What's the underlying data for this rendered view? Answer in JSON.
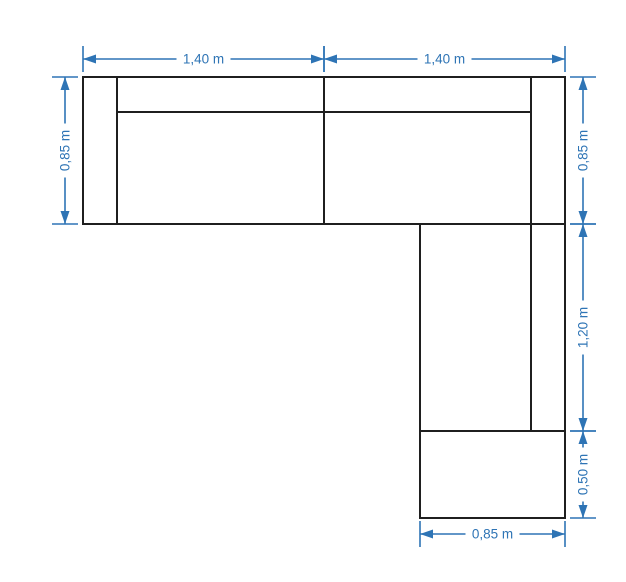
{
  "colors": {
    "accent": "#2e74b5",
    "outline": "#1f1f1f",
    "background": "#ffffff"
  },
  "drawing": {
    "figure": "l-shaped-sectional-sofa-top-view",
    "unit": "m"
  },
  "dimensions": [
    {
      "id": "top-left",
      "label": "1,40 m",
      "value_m": 1.4,
      "axis": "h",
      "at": 59,
      "from": 83,
      "to": 324
    },
    {
      "id": "top-right",
      "label": "1,40 m",
      "value_m": 1.4,
      "axis": "h",
      "at": 59,
      "from": 324,
      "to": 565
    },
    {
      "id": "left",
      "label": "0,85 m",
      "value_m": 0.85,
      "axis": "v",
      "at": 65,
      "from": 77,
      "to": 224
    },
    {
      "id": "right-upper",
      "label": "0,85 m",
      "value_m": 0.85,
      "axis": "v",
      "at": 583,
      "from": 77,
      "to": 224
    },
    {
      "id": "right-middle",
      "label": "1,20 m",
      "value_m": 1.2,
      "axis": "v",
      "at": 583,
      "from": 224,
      "to": 431
    },
    {
      "id": "right-lower",
      "label": "0,50 m",
      "value_m": 0.5,
      "axis": "v",
      "at": 583,
      "from": 431,
      "to": 518
    },
    {
      "id": "bottom",
      "label": "0,85 m",
      "value_m": 0.85,
      "axis": "h",
      "at": 534,
      "from": 420,
      "to": 565
    }
  ]
}
